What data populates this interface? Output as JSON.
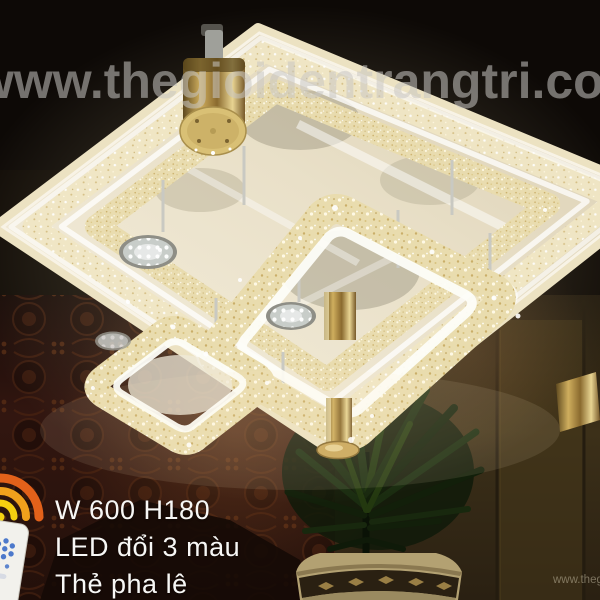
{
  "watermark": {
    "main": "www.thegioidentrangtri.com",
    "corner": "www.thegioidentrangtri.com"
  },
  "product": {
    "size_label": "W 600 H180",
    "led_label": "LED đổi 3 màu",
    "material_label": "Thẻ pha lê"
  },
  "icons": {
    "remote": "remote-control-icon",
    "signal": "wireless-signal-icon"
  },
  "colors": {
    "gold_accent": "#c9a85c",
    "crystal_champagne": "#e9dcae",
    "signal_outer_orange": "#e2611a",
    "signal_mid_orange": "#f0a11c",
    "signal_yellow": "#f5d211",
    "remote_button_blue": "#4d79cb",
    "text_white": "#f7f7f5",
    "watermark_gray": "#c9c7c3",
    "tapestry_maroon": "#2c120c",
    "wall_olive": "#3a2e19",
    "plant_green": "#1a2c10"
  }
}
